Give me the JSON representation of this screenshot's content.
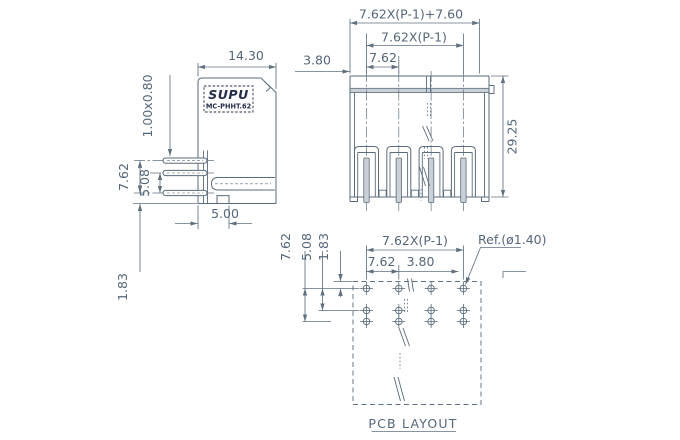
{
  "side_view": {
    "logo": "SUPU",
    "model": "MC-PHHT.62",
    "dims": {
      "body_width": "14.30",
      "pin_cross_section": "1.00x0.80",
      "pin_row_span": "7.62",
      "pin_row_gap": "5.08",
      "pin_bottom_offset": "1.83",
      "front_depth": "5.00"
    }
  },
  "front_view": {
    "dims": {
      "total_length": "7.62X(P-1)+7.60",
      "pin_span": "7.62X(P-1)",
      "pitch": "7.62",
      "edge_to_pin": "3.80",
      "height": "29.25"
    }
  },
  "pcb_layout": {
    "caption": "PCB LAYOUT",
    "hole_reference": "Ref.(ø1.40)",
    "grid": {
      "columns": 4,
      "rows": 3
    },
    "dims": {
      "col_span": "7.62X(P-1)",
      "pitch": "7.62",
      "half_pitch": "3.80",
      "row_span": "7.62",
      "row_gap": "5.08",
      "edge_offset": "1.83"
    }
  },
  "colors": {
    "line": "#60707f",
    "text": "#54667a",
    "outline": "#5a6b7b",
    "logo": "#232b4a",
    "fill": "#c9d1d7",
    "background": "#ffffff"
  }
}
